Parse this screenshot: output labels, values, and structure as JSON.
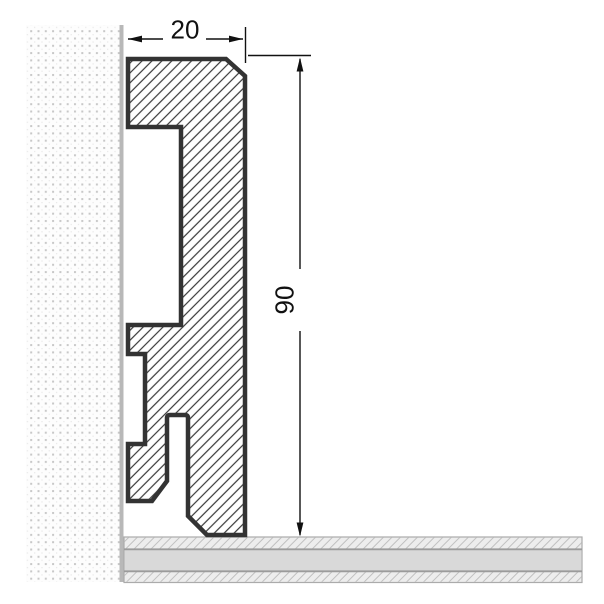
{
  "figure": {
    "description": "Skirting board profile cross-section with wall and floor",
    "width_dimension": {
      "label": "20"
    },
    "height_dimension": {
      "label": "90"
    }
  },
  "colors": {
    "background": "#ffffff",
    "outline": "#333333",
    "hatch": "#383838",
    "dimension": "#111111",
    "wall_bg": "#fdfdfd",
    "wall_dot": "#c8c8c8",
    "wall_dot_faint": "#e7e7e7",
    "wall_line": "#b8b8b8",
    "floor_bg": "#ededed",
    "floor_hatch": "#c0c0c0",
    "floor_mid": "#d9d9d9",
    "floor_line": "#9b9b9b",
    "floor_edge": "#ababab"
  }
}
